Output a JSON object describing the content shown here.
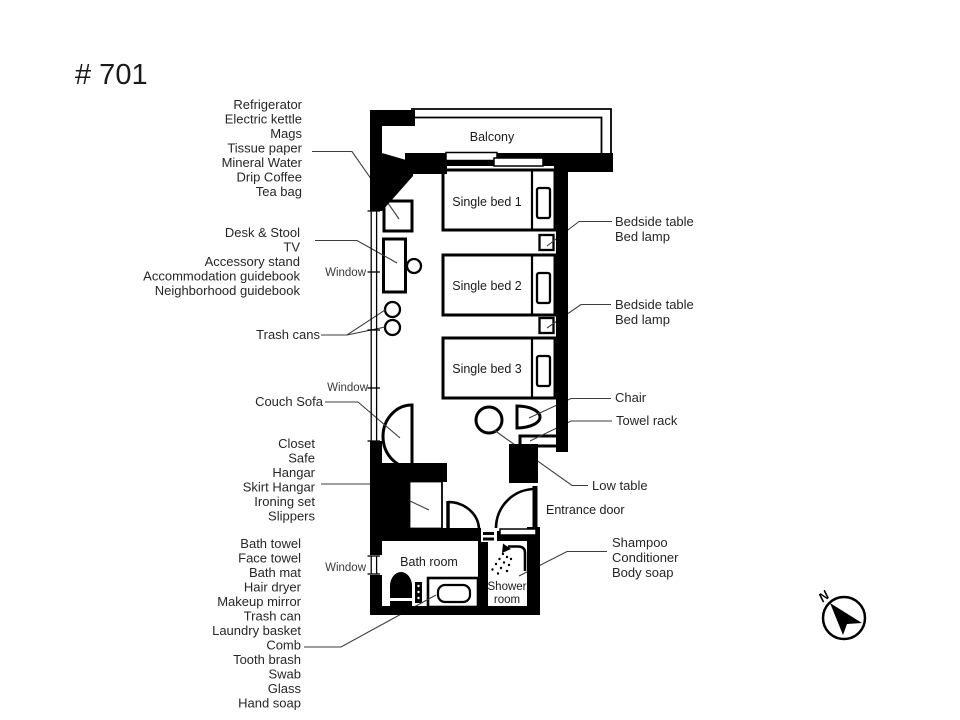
{
  "title": "# 701",
  "plan": {
    "balcony": "Balcony",
    "beds": [
      "Single bed 1",
      "Single bed 2",
      "Single bed 3"
    ],
    "bath_room": "Bath room",
    "shower_room_line1": "Shower",
    "shower_room_line2": "room",
    "entrance_door": "Entrance door",
    "windows": [
      "Window",
      "Window",
      "Window"
    ]
  },
  "left_labels": {
    "amenity_group": [
      "Refrigerator",
      "Electric kettle",
      "Mags",
      "Tissue paper",
      "Mineral Water",
      "Drip Coffee",
      "Tea bag"
    ],
    "desk_group": [
      "Desk & Stool",
      "TV",
      "Accessory stand",
      "Accommodation guidebook",
      "Neighborhood guidebook"
    ],
    "trash_cans": "Trash cans",
    "couch_sofa": "Couch Sofa",
    "closet_group": [
      "Closet",
      "Safe",
      "Hangar",
      "Skirt Hangar",
      "Ironing set",
      "Slippers"
    ],
    "bath_group": [
      "Bath towel",
      "Face towel",
      "Bath mat",
      "Hair dryer",
      "Makeup mirror",
      "Trash can",
      "Laundry basket",
      "Comb",
      "Tooth brash",
      "Swab",
      "Glass",
      "Hand soap"
    ]
  },
  "right_labels": {
    "bedside_group_1": [
      "Bedside table",
      "Bed lamp"
    ],
    "bedside_group_2": [
      "Bedside table",
      "Bed lamp"
    ],
    "chair": "Chair",
    "towel_rack": "Towel rack",
    "low_table": "Low table",
    "shampoo_group": [
      "Shampoo",
      "Conditioner",
      "Body soap"
    ]
  },
  "compass": {
    "north_label": "N"
  },
  "colors": {
    "wall": "#000000",
    "leader_line": "#3d3d3d",
    "text": "#262626",
    "background": "#ffffff"
  }
}
